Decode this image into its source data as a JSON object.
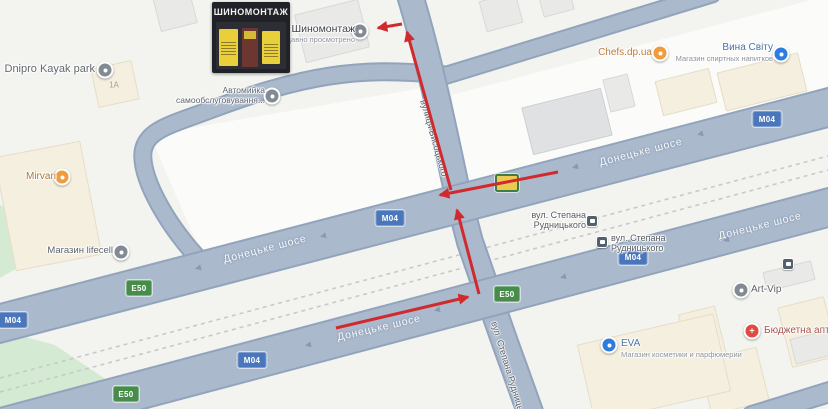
{
  "map": {
    "colors": {
      "land": "#f3f4f0",
      "road": "#aab9cc",
      "road_casing": "#92a4bc",
      "green": "#d5ead2",
      "railway": "#c9c9c9",
      "badge_m04": "#4a77bc",
      "badge_e50": "#478c4a",
      "arrow_red": "#d02a2e"
    },
    "photo": {
      "sign": "ШИНОМОНТАЖ"
    },
    "building_label": {
      "text": "1А"
    },
    "road_labels": [
      {
        "text": "Донецьке шосе",
        "x": 265,
        "y": 249,
        "rot": -14.5
      },
      {
        "text": "Донецьке шосе",
        "x": 641,
        "y": 152,
        "rot": -14.5
      },
      {
        "text": "Донецьке шосе",
        "x": 379,
        "y": 328,
        "rot": -13
      },
      {
        "text": "Донецьке шосе",
        "x": 760,
        "y": 226,
        "rot": -14
      }
    ],
    "street_labels": [
      {
        "text": "вулиця Висоцького",
        "x": 434,
        "y": 138,
        "rot": 74,
        "size": 9
      },
      {
        "text": "вул. Степана Рудницького",
        "x": 510,
        "y": 374,
        "rot": 73,
        "size": 9
      }
    ],
    "route_badges": [
      {
        "type": "M04",
        "text": "M04",
        "x": 13,
        "y": 320
      },
      {
        "type": "E50",
        "text": "E50",
        "x": 139,
        "y": 288
      },
      {
        "type": "M04",
        "text": "M04",
        "x": 390,
        "y": 218
      },
      {
        "type": "SP",
        "text": "",
        "x": 507,
        "y": 183
      },
      {
        "type": "M04",
        "text": "M04",
        "x": 767,
        "y": 119
      },
      {
        "type": "E50",
        "text": "E50",
        "x": 126,
        "y": 394
      },
      {
        "type": "M04",
        "text": "M04",
        "x": 252,
        "y": 360
      },
      {
        "type": "E50",
        "text": "E50",
        "x": 507,
        "y": 294
      },
      {
        "type": "M04",
        "text": "M04",
        "x": 633,
        "y": 257
      }
    ],
    "chevrons": [
      {
        "x": 198,
        "y": 268
      },
      {
        "x": 323,
        "y": 236
      },
      {
        "x": 575,
        "y": 167
      },
      {
        "x": 700,
        "y": 134
      },
      {
        "x": 308,
        "y": 345
      },
      {
        "x": 437,
        "y": 310
      },
      {
        "x": 563,
        "y": 277
      },
      {
        "x": 726,
        "y": 240
      }
    ],
    "pois": [
      {
        "id": "dnipro-kayak-park",
        "label": "Dnipro Kayak park",
        "cx": 105,
        "cy": 70,
        "kind": "generic",
        "align": "right",
        "lx": 733,
        "ly": 63,
        "color": "#62686d",
        "size": 11
      },
      {
        "id": "shynomontazh",
        "label": "Шиномонтаж",
        "sub": "Недавно просмотрено",
        "cx": 360,
        "cy": 31,
        "kind": "generic",
        "align": "right",
        "lx": 473,
        "ly": 23,
        "color": "#3e4347",
        "size": 10.5
      },
      {
        "id": "avtomyika",
        "lines": [
          "Автомийка",
          "самообслуговування..."
        ],
        "cx": 272,
        "cy": 96,
        "kind": "generic",
        "align": "right",
        "lx": 563,
        "ly": 86,
        "color": "#5e646b",
        "size": 8.5
      },
      {
        "id": "mirvari",
        "label": "Mirvari",
        "cx": 62,
        "cy": 177,
        "kind": "food",
        "align": "right",
        "lx": 772,
        "ly": 171,
        "color": "#a9763c",
        "size": 10
      },
      {
        "id": "mahazyn-lifecell",
        "label": "Магазин lifecell",
        "cx": 121,
        "cy": 252,
        "kind": "generic",
        "align": "right",
        "lx": 715,
        "ly": 246,
        "color": "#5e646b",
        "size": 9.5
      },
      {
        "id": "chefs-dp-ua",
        "label": "Chefs.dp.ua",
        "cx": 660,
        "cy": 53,
        "kind": "food",
        "align": "right",
        "lx": 176,
        "ly": 47,
        "color": "#bb7c3a",
        "size": 10
      },
      {
        "id": "vyna-svitu",
        "label": "Вина Світу",
        "sub": "Магазин спиртных напитков",
        "cx": 781,
        "cy": 54,
        "kind": "shop",
        "align": "right",
        "lx": 55,
        "ly": 42,
        "color": "#4a73a8",
        "size": 10
      },
      {
        "id": "stop-rudnytskoho-1",
        "lines": [
          "вул. Степана",
          "Рудницького"
        ],
        "cx": 592,
        "cy": 221,
        "kind": "bus",
        "align": "right",
        "lx": 242,
        "ly": 210,
        "color": "#565c63",
        "size": 9
      },
      {
        "id": "stop-rudnytskoho-2",
        "lines": [
          "вул. Степана",
          "Рудницького"
        ],
        "cx": 602,
        "cy": 242,
        "kind": "bus",
        "align": "left",
        "lx": 611,
        "ly": 233,
        "color": "#565c63",
        "size": 9
      },
      {
        "id": "art-vip",
        "label": "Art-Vip",
        "cx": 741,
        "cy": 290,
        "kind": "generic",
        "align": "left",
        "lx": 751,
        "ly": 284,
        "color": "#5e646b",
        "size": 10
      },
      {
        "id": "biudzhetna-apteka",
        "label": "Бюджетна аптека",
        "cx": 752,
        "cy": 331,
        "kind": "pharmacy",
        "align": "left",
        "lx": 764,
        "ly": 325,
        "color": "#a8544c",
        "size": 10
      },
      {
        "id": "eva",
        "label": "EVA",
        "sub": "Магазин косметики и парфюмерии",
        "cx": 609,
        "cy": 345,
        "kind": "shop",
        "align": "left",
        "lx": 621,
        "ly": 338,
        "color": "#4a73a8",
        "size": 10
      },
      {
        "id": "bus-stop",
        "label": "",
        "cx": 788,
        "cy": 264,
        "kind": "bus",
        "align": "left",
        "lx": 0,
        "ly": 0,
        "color": "#565c63",
        "size": 9
      }
    ],
    "arrows": [
      {
        "x1": 336,
        "y1": 328,
        "x2": 468,
        "y2": 297
      },
      {
        "x1": 479,
        "y1": 294,
        "x2": 457,
        "y2": 210
      },
      {
        "x1": 558,
        "y1": 172,
        "x2": 440,
        "y2": 195
      },
      {
        "x1": 451,
        "y1": 190,
        "x2": 407,
        "y2": 32
      },
      {
        "x1": 402,
        "y1": 24,
        "x2": 378,
        "y2": 28
      }
    ]
  }
}
